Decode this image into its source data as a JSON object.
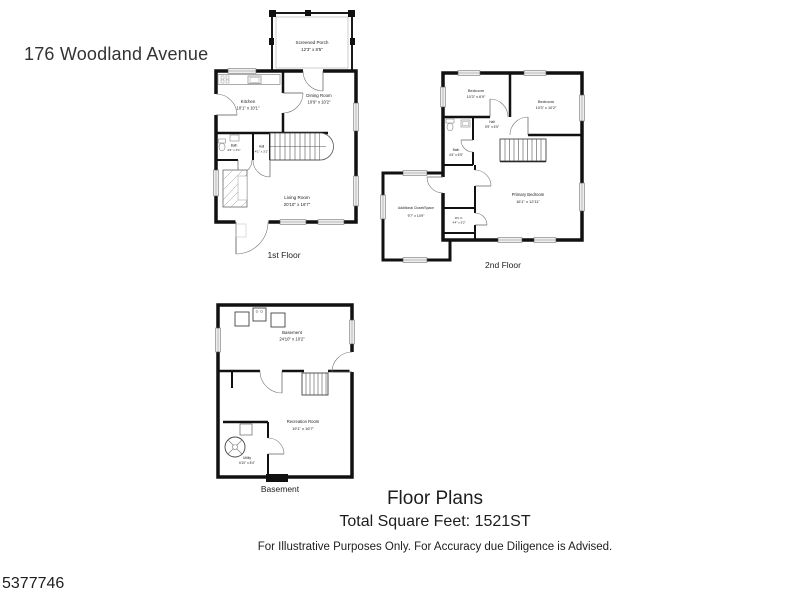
{
  "page": {
    "address": "176 Woodland Avenue",
    "footer_title": "Floor Plans",
    "footer_sqft": "Total Square Feet:  1521ST",
    "disclaimer": "For Illustrative Purposes Only.  For Accuracy due Diligence is Advised.",
    "watermark_id": "5377746"
  },
  "floors": {
    "first": {
      "label": "1st Floor",
      "rooms": {
        "screened_porch": {
          "name": "Screened Porch",
          "dims": "12'3\" x 8'5\""
        },
        "kitchen": {
          "name": "Kitchen",
          "dims": "10'1\" x 10'1\""
        },
        "dining_room": {
          "name": "Dining Room",
          "dims": "10'9\" x 10'2\""
        },
        "bath": {
          "name": "Bath",
          "dims": "4'2\" x 3'1\""
        },
        "hall": {
          "name": "Hall",
          "dims": "4'1\" x 3'1\""
        },
        "living_room": {
          "name": "Living Room",
          "dims": "20'10\" x 16'7\""
        }
      }
    },
    "second": {
      "label": "2nd Floor",
      "rooms": {
        "bedroom_left": {
          "name": "Bedroom",
          "dims": "10'3\" x 6'9\""
        },
        "bedroom_right": {
          "name": "Bedroom",
          "dims": "10'3\" x 10'2\""
        },
        "hall": {
          "name": "Hall",
          "dims": "5'9\" x 6'5\""
        },
        "bath": {
          "name": "Bath",
          "dims": "4'4\" x 6'5\""
        },
        "primary_bedroom": {
          "name": "Primary Bedroom",
          "dims": "16'1\" x 12'11\""
        },
        "wic": {
          "name": "W.I.C.",
          "dims": "4'4\" x 5'2\""
        },
        "additional_closet": {
          "name": "Additional Closet/Space",
          "dims": "9'7\" x 14'9\""
        }
      }
    },
    "basement": {
      "label": "Basement",
      "rooms": {
        "basement_room": {
          "name": "Basement",
          "dims": "24'10\" x 10'2\""
        },
        "recreation_room": {
          "name": "Recreation Room",
          "dims": "19'1\" x 16'7\""
        },
        "utility": {
          "name": "Utility",
          "dims": "6'10\" x 8'4\""
        }
      }
    }
  },
  "colors": {
    "wall": "#111111",
    "thin_line": "#555555",
    "text": "#1c1c1c",
    "background": "#ffffff"
  }
}
